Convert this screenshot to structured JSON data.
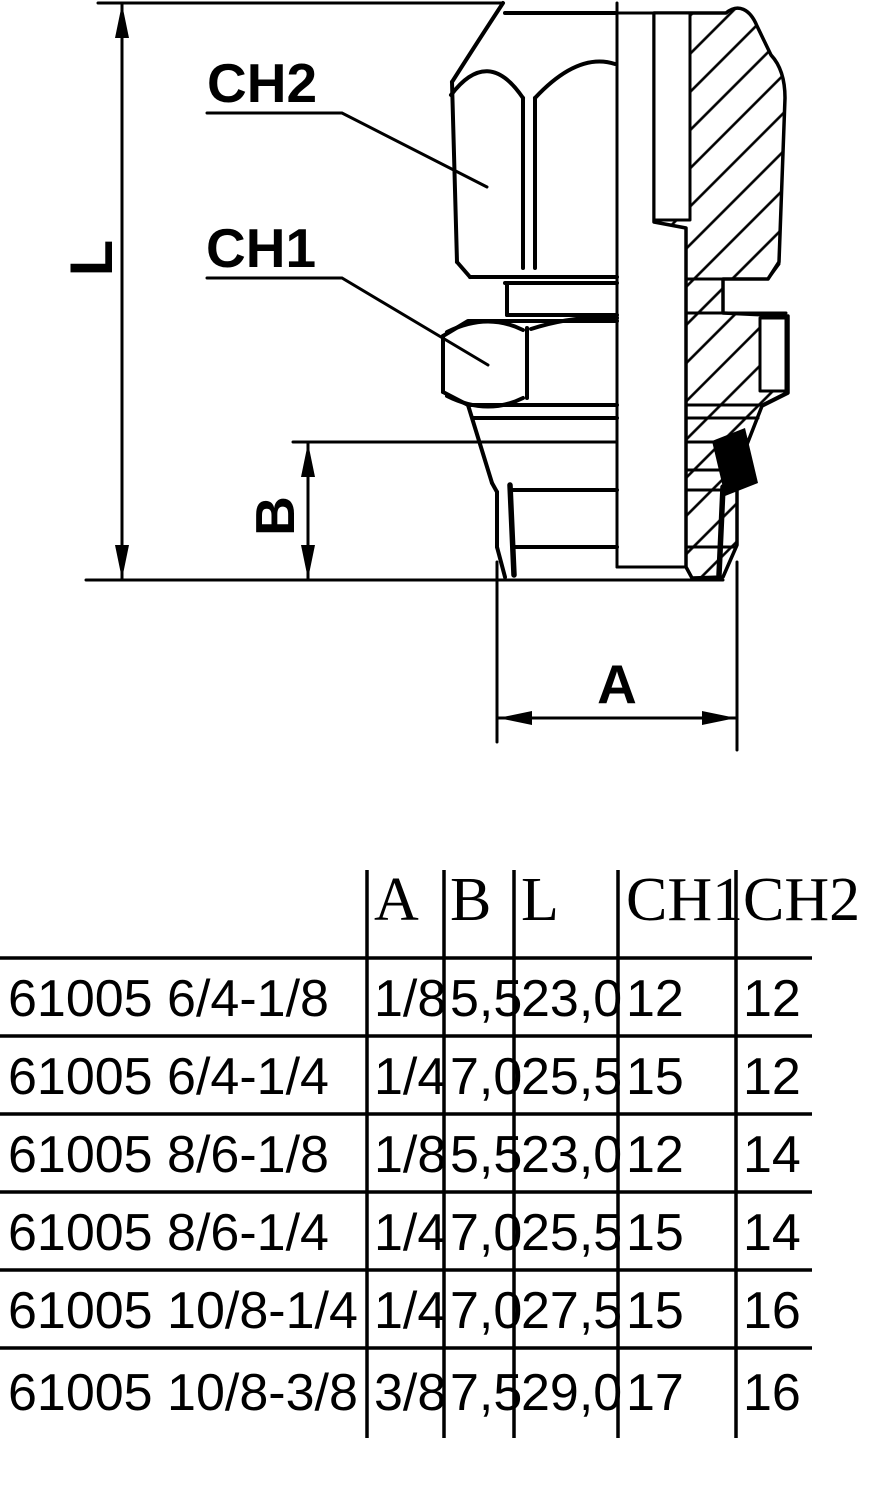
{
  "drawing": {
    "labels": {
      "length": "L",
      "depth": "B",
      "thread": "A",
      "hex1": "CH1",
      "hex2": "CH2"
    }
  },
  "table": {
    "headers": {
      "part": "",
      "a": "A",
      "b": "B",
      "l": "L",
      "ch1": "CH1",
      "ch2": "CH2"
    },
    "rows": [
      {
        "part": "61005 6/4-1/8",
        "a": "1/8",
        "b": "5,5",
        "l": "23,0",
        "ch1": "12",
        "ch2": "12"
      },
      {
        "part": "61005 6/4-1/4",
        "a": "1/4",
        "b": "7,0",
        "l": "25,5",
        "ch1": "15",
        "ch2": "12"
      },
      {
        "part": "61005 8/6-1/8",
        "a": "1/8",
        "b": "5,5",
        "l": "23,0",
        "ch1": "12",
        "ch2": "14"
      },
      {
        "part": "61005 8/6-1/4",
        "a": "1/4",
        "b": "7,0",
        "l": "25,5",
        "ch1": "15",
        "ch2": "14"
      },
      {
        "part": "61005 10/8-1/4",
        "a": "1/4",
        "b": "7,0",
        "l": "27,5",
        "ch1": "15",
        "ch2": "16"
      },
      {
        "part": "61005 10/8-3/8",
        "a": "3/8",
        "b": "7,5",
        "l": "29,0",
        "ch1": "17",
        "ch2": "16"
      }
    ]
  },
  "colors": {
    "ink": "#000000",
    "paper": "#ffffff"
  }
}
